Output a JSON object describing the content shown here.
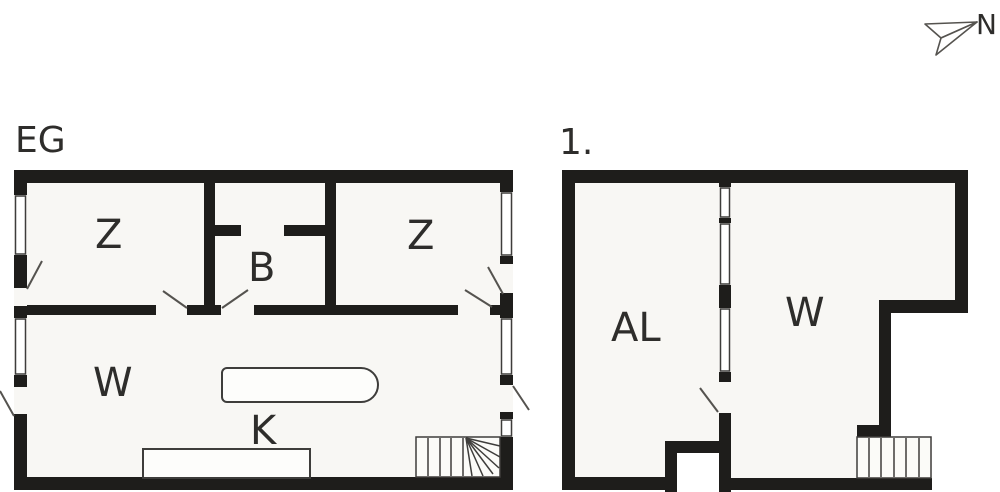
{
  "document_type": "floor-plan-drawing",
  "north_indicator": {
    "label": "N"
  },
  "floors": [
    {
      "title": "EG",
      "rooms": [
        "Z",
        "B",
        "Z",
        "W",
        "K"
      ]
    },
    {
      "title": "1.",
      "rooms": [
        "AL",
        "W"
      ]
    }
  ],
  "colors": {
    "wall": "#1e1d1b",
    "room_fill": "#f8f7f4",
    "line": "#3e3d3b",
    "swing_line": "#55534f",
    "background": "#ffffff",
    "text": "#2e2d2b"
  }
}
